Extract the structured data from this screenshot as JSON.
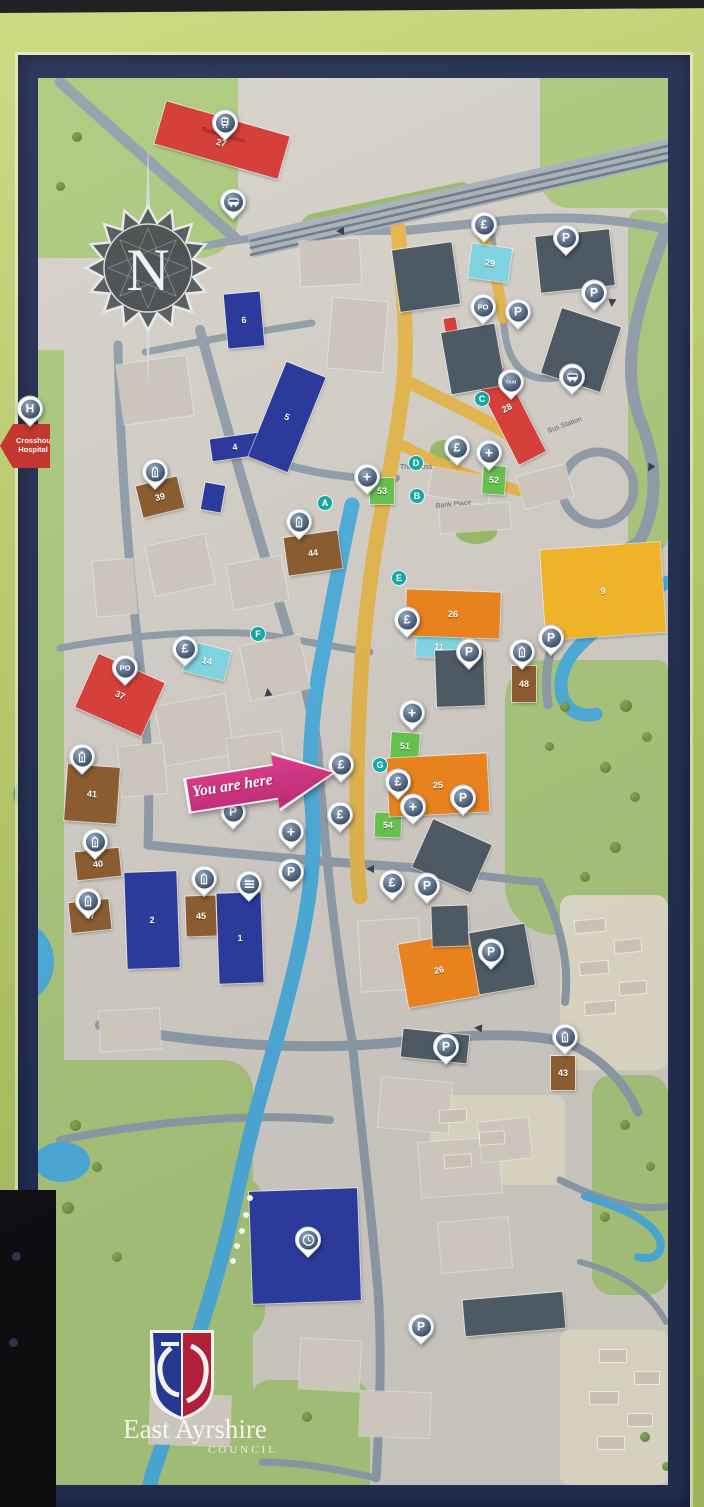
{
  "sign": {
    "you_are_here_label": "You are here",
    "hospital_sign": {
      "text": "Crosshouse Hospital"
    },
    "council_logo": {
      "line1": "East Ayrshire",
      "line2": "COUNCIL"
    },
    "compass_letter": "N"
  },
  "colors": {
    "board_green": "#c3d56f",
    "frame_navy": "#232e55",
    "map_base": "#d8d3ca",
    "park_green": "#aecb7d",
    "road_gray": "#93a0ab",
    "main_road_yellow": "#e9b94d",
    "river_blue": "#4fb0df",
    "pin_circle_blue": "#41536b",
    "you_are_here_pink": "#cc2f7b",
    "building_red": "#d6403a",
    "building_blue": "#2c3a9c",
    "building_orange": "#e8821f",
    "building_brown": "#8a5c30",
    "building_cyan": "#7ed3de",
    "building_green": "#67bf4e",
    "building_yellow": "#efb32a",
    "building_dark": "#4d5a64"
  },
  "map": {
    "street_labels": [
      {
        "text": "The Cross",
        "x": 400,
        "y": 464,
        "rot": 0
      },
      {
        "text": "Bank Place",
        "x": 436,
        "y": 503,
        "rot": -6
      },
      {
        "text": "Bus Station",
        "x": 548,
        "y": 428,
        "rot": -20
      }
    ],
    "route_letters": [
      {
        "letter": "A",
        "x": 325,
        "y": 503
      },
      {
        "letter": "B",
        "x": 417,
        "y": 496
      },
      {
        "letter": "C",
        "x": 482,
        "y": 399
      },
      {
        "letter": "D",
        "x": 416,
        "y": 463
      },
      {
        "letter": "E",
        "x": 399,
        "y": 578
      },
      {
        "letter": "F",
        "x": 258,
        "y": 634
      },
      {
        "letter": "G",
        "x": 380,
        "y": 765
      }
    ],
    "buildings": [
      {
        "number": "27",
        "color": "red",
        "x": 158,
        "y": 118,
        "w": 128,
        "h": 44,
        "rot": 16,
        "label": "Railway Station"
      },
      {
        "number": "28",
        "color": "red",
        "x": 492,
        "y": 352,
        "w": 30,
        "h": 112,
        "rot": -27
      },
      {
        "number": "",
        "color": "red",
        "x": 445,
        "y": 318,
        "w": 12,
        "h": 20,
        "rot": -10
      },
      {
        "number": "6",
        "color": "blue",
        "x": 226,
        "y": 293,
        "w": 36,
        "h": 54,
        "rot": -5
      },
      {
        "number": "4",
        "color": "blue",
        "x": 211,
        "y": 436,
        "w": 48,
        "h": 22,
        "rot": -8
      },
      {
        "number": "5",
        "color": "blue",
        "x": 266,
        "y": 366,
        "w": 42,
        "h": 102,
        "rot": 22
      },
      {
        "number": "",
        "color": "blue",
        "x": 203,
        "y": 484,
        "w": 20,
        "h": 27,
        "rot": 10
      },
      {
        "number": "39",
        "color": "brown",
        "x": 139,
        "y": 481,
        "w": 42,
        "h": 32,
        "rot": -14
      },
      {
        "number": "44",
        "color": "brown",
        "x": 286,
        "y": 534,
        "w": 54,
        "h": 38,
        "rot": -8
      },
      {
        "number": "29",
        "color": "cyan",
        "x": 470,
        "y": 246,
        "w": 40,
        "h": 34,
        "rot": 8
      },
      {
        "number": "37",
        "color": "red",
        "x": 84,
        "y": 666,
        "w": 72,
        "h": 58,
        "rot": 24
      },
      {
        "number": "14",
        "color": "cyan",
        "x": 186,
        "y": 646,
        "w": 42,
        "h": 30,
        "rot": 14
      },
      {
        "number": "11",
        "color": "cyan",
        "x": 416,
        "y": 636,
        "w": 46,
        "h": 22,
        "rot": 4
      },
      {
        "number": "53",
        "color": "green",
        "x": 370,
        "y": 478,
        "w": 24,
        "h": 26,
        "rot": 0
      },
      {
        "number": "52",
        "color": "green",
        "x": 483,
        "y": 466,
        "w": 22,
        "h": 28,
        "rot": 4
      },
      {
        "number": "51",
        "color": "green",
        "x": 391,
        "y": 733,
        "w": 28,
        "h": 26,
        "rot": 4
      },
      {
        "number": "54",
        "color": "green",
        "x": 375,
        "y": 813,
        "w": 26,
        "h": 24,
        "rot": 2
      },
      {
        "number": "26",
        "color": "orange",
        "x": 406,
        "y": 591,
        "w": 94,
        "h": 46,
        "rot": 2
      },
      {
        "number": "25",
        "color": "orange",
        "x": 388,
        "y": 756,
        "w": 100,
        "h": 58,
        "rot": -3
      },
      {
        "number": "26",
        "color": "orange",
        "x": 403,
        "y": 938,
        "w": 72,
        "h": 64,
        "rot": -10
      },
      {
        "number": "9",
        "color": "yellow",
        "x": 543,
        "y": 546,
        "w": 120,
        "h": 90,
        "rot": -4
      },
      {
        "number": "48",
        "color": "brown",
        "x": 512,
        "y": 666,
        "w": 24,
        "h": 36,
        "rot": 0
      },
      {
        "number": "41",
        "color": "brown",
        "x": 66,
        "y": 766,
        "w": 52,
        "h": 56,
        "rot": 4
      },
      {
        "number": "40",
        "color": "brown",
        "x": 76,
        "y": 850,
        "w": 44,
        "h": 28,
        "rot": -6
      },
      {
        "number": "47",
        "color": "brown",
        "x": 70,
        "y": 901,
        "w": 40,
        "h": 30,
        "rot": -6
      },
      {
        "number": "2",
        "color": "blue",
        "x": 126,
        "y": 872,
        "w": 52,
        "h": 96,
        "rot": -2
      },
      {
        "number": "45",
        "color": "brown",
        "x": 186,
        "y": 896,
        "w": 30,
        "h": 40,
        "rot": -2
      },
      {
        "number": "1",
        "color": "blue",
        "x": 218,
        "y": 893,
        "w": 44,
        "h": 90,
        "rot": -2
      },
      {
        "number": "43",
        "color": "brown",
        "x": 551,
        "y": 1056,
        "w": 24,
        "h": 34,
        "rot": 0
      },
      {
        "number": "19",
        "color": "blue",
        "x": 251,
        "y": 1190,
        "w": 108,
        "h": 112,
        "rot": -2
      },
      {
        "number": "",
        "color": "dark",
        "x": 396,
        "y": 246,
        "w": 60,
        "h": 62,
        "rot": -8
      },
      {
        "number": "",
        "color": "dark",
        "x": 446,
        "y": 328,
        "w": 54,
        "h": 62,
        "rot": -10
      },
      {
        "number": "",
        "color": "dark",
        "x": 538,
        "y": 233,
        "w": 74,
        "h": 56,
        "rot": -6
      },
      {
        "number": "",
        "color": "dark",
        "x": 550,
        "y": 316,
        "w": 62,
        "h": 68,
        "rot": 18
      },
      {
        "number": "",
        "color": "dark",
        "x": 436,
        "y": 650,
        "w": 48,
        "h": 56,
        "rot": -2
      },
      {
        "number": "",
        "color": "dark",
        "x": 420,
        "y": 830,
        "w": 64,
        "h": 52,
        "rot": 24
      },
      {
        "number": "",
        "color": "dark",
        "x": 432,
        "y": 906,
        "w": 36,
        "h": 40,
        "rot": -2
      },
      {
        "number": "",
        "color": "dark",
        "x": 474,
        "y": 928,
        "w": 56,
        "h": 62,
        "rot": -10
      },
      {
        "number": "",
        "color": "dark",
        "x": 402,
        "y": 1032,
        "w": 66,
        "h": 28,
        "rot": 6
      },
      {
        "number": "",
        "color": "dark",
        "x": 464,
        "y": 1296,
        "w": 100,
        "h": 36,
        "rot": -5
      }
    ],
    "pins": [
      {
        "type": "train",
        "x": 225,
        "y": 128
      },
      {
        "type": "bus",
        "x": 233,
        "y": 207
      },
      {
        "type": "pound",
        "x": 484,
        "y": 230
      },
      {
        "type": "parking",
        "x": 566,
        "y": 243
      },
      {
        "type": "parking",
        "x": 594,
        "y": 298
      },
      {
        "type": "post-office",
        "x": 483,
        "y": 312
      },
      {
        "type": "parking",
        "x": 518,
        "y": 317
      },
      {
        "type": "taxi",
        "x": 511,
        "y": 387
      },
      {
        "type": "bus",
        "x": 572,
        "y": 382
      },
      {
        "type": "hospital",
        "x": 30,
        "y": 414,
        "fixed": true
      },
      {
        "type": "church",
        "x": 155,
        "y": 477
      },
      {
        "type": "pound",
        "x": 457,
        "y": 453
      },
      {
        "type": "medical",
        "x": 489,
        "y": 458
      },
      {
        "type": "medical",
        "x": 367,
        "y": 482
      },
      {
        "type": "church",
        "x": 299,
        "y": 527
      },
      {
        "type": "pound",
        "x": 407,
        "y": 625
      },
      {
        "type": "parking",
        "x": 469,
        "y": 657
      },
      {
        "type": "church",
        "x": 522,
        "y": 657
      },
      {
        "type": "parking",
        "x": 551,
        "y": 643
      },
      {
        "type": "pound",
        "x": 185,
        "y": 654
      },
      {
        "type": "post-office",
        "x": 125,
        "y": 673
      },
      {
        "type": "medical",
        "x": 412,
        "y": 718
      },
      {
        "type": "church",
        "x": 82,
        "y": 762
      },
      {
        "type": "pound",
        "x": 341,
        "y": 770
      },
      {
        "type": "pound",
        "x": 398,
        "y": 787
      },
      {
        "type": "parking",
        "x": 463,
        "y": 803
      },
      {
        "type": "medical",
        "x": 413,
        "y": 812
      },
      {
        "type": "pound",
        "x": 340,
        "y": 820
      },
      {
        "type": "parking",
        "x": 233,
        "y": 817
      },
      {
        "type": "medical",
        "x": 291,
        "y": 837
      },
      {
        "type": "parking",
        "x": 291,
        "y": 877
      },
      {
        "type": "church",
        "x": 95,
        "y": 847
      },
      {
        "type": "church",
        "x": 88,
        "y": 906
      },
      {
        "type": "church",
        "x": 204,
        "y": 884
      },
      {
        "type": "library",
        "x": 249,
        "y": 889
      },
      {
        "type": "pound",
        "x": 392,
        "y": 888
      },
      {
        "type": "parking",
        "x": 427,
        "y": 891
      },
      {
        "type": "parking",
        "x": 491,
        "y": 957
      },
      {
        "type": "parking",
        "x": 446,
        "y": 1052
      },
      {
        "type": "church",
        "x": 565,
        "y": 1042
      },
      {
        "type": "clock",
        "x": 308,
        "y": 1245
      },
      {
        "type": "parking",
        "x": 421,
        "y": 1332
      }
    ],
    "pin_glyphs": {
      "pound": "£",
      "parking": "P",
      "post-office": "PO",
      "taxi": "TAXI",
      "medical": "+",
      "hospital": "H"
    }
  }
}
